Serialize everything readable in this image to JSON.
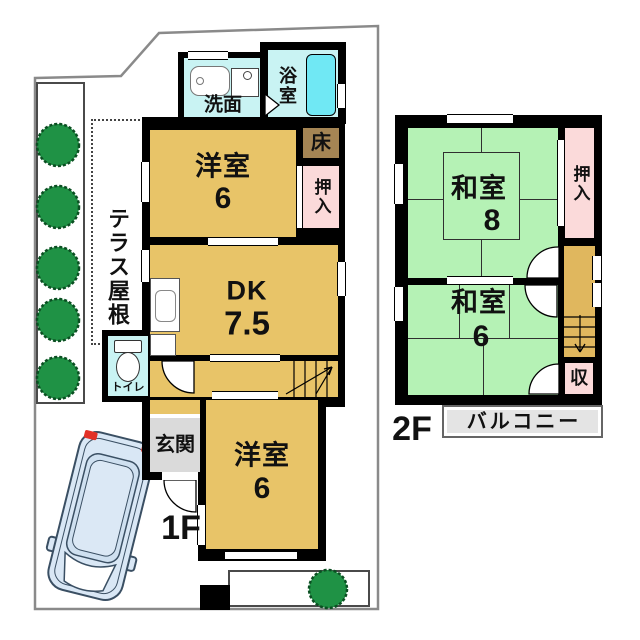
{
  "floor1": {
    "floor_label": "1F",
    "terrace_label": "テラス屋根",
    "rooms": {
      "washroom": {
        "label": "洗面"
      },
      "bathroom": {
        "label": "浴室"
      },
      "tokonoma": {
        "label": "床"
      },
      "closet": {
        "label": "押入"
      },
      "western_room_top": {
        "label": "洋室",
        "size": "6"
      },
      "dining_kitchen": {
        "label": "DK",
        "size": "7.5"
      },
      "toilet": {
        "label": "トイレ"
      },
      "entrance": {
        "label": "玄関"
      },
      "western_room_bottom": {
        "label": "洋室",
        "size": "6"
      }
    }
  },
  "floor2": {
    "floor_label": "2F",
    "rooms": {
      "japanese_room_8": {
        "label": "和室",
        "size": "8"
      },
      "closet": {
        "label": "押入"
      },
      "japanese_room_6": {
        "label": "和室",
        "size": "6"
      },
      "storage": {
        "label": "収"
      },
      "balcony": {
        "label": "バルコニー"
      }
    }
  },
  "colors": {
    "wall": "#000000",
    "western_room": "#E8C468",
    "japanese_room": "#B5F2B5",
    "closet_pink": "#FBDADA",
    "wet_area_cyan": "#C9F3F3",
    "bathtub_cyan": "#70E8F4",
    "tokonoma_brown": "#A58554",
    "entrance_gray": "#DADADA",
    "balcony_gray": "#E4E4E4",
    "tree_green": "#1F9245",
    "car_blue": "#D9E7F5",
    "boundary_gray": "#8A8A8A"
  }
}
